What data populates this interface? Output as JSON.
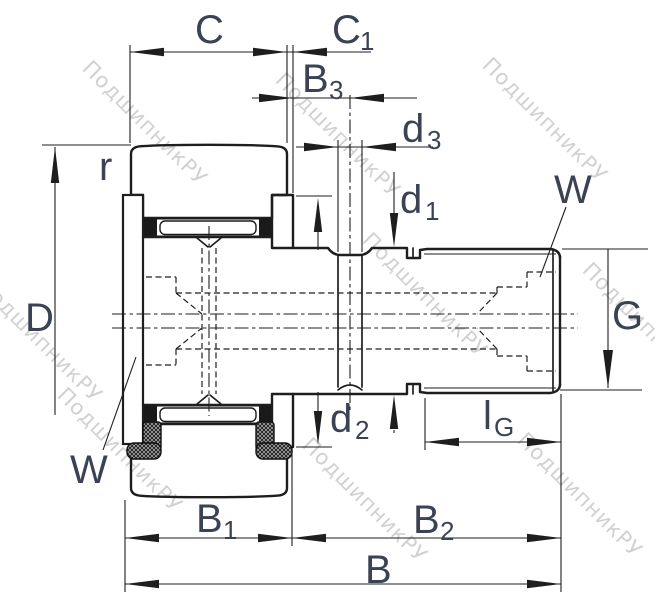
{
  "watermark": {
    "text": "ПодшипникРУ"
  },
  "colors": {
    "background": "#ffffff",
    "line": "#1e1e1e",
    "label": "#3a4254",
    "watermark": "#c9c9c9"
  },
  "labels": {
    "c": {
      "main": "C"
    },
    "c1": {
      "main": "C",
      "sub": "1"
    },
    "b3": {
      "main": "B",
      "sub": "3"
    },
    "d3": {
      "main": "d",
      "sub": "3"
    },
    "d1": {
      "main": "d",
      "sub": "1"
    },
    "d2": {
      "main": "d",
      "sub": "2"
    },
    "r": {
      "main": "r"
    },
    "D": {
      "main": "D"
    },
    "w_left": {
      "main": "W"
    },
    "w_right": {
      "main": "W"
    },
    "g": {
      "main": "G"
    },
    "lg": {
      "main": "l",
      "sub": "G"
    },
    "b1": {
      "main": "B",
      "sub": "1"
    },
    "b2": {
      "main": "B",
      "sub": "2"
    },
    "b": {
      "main": "B"
    }
  }
}
